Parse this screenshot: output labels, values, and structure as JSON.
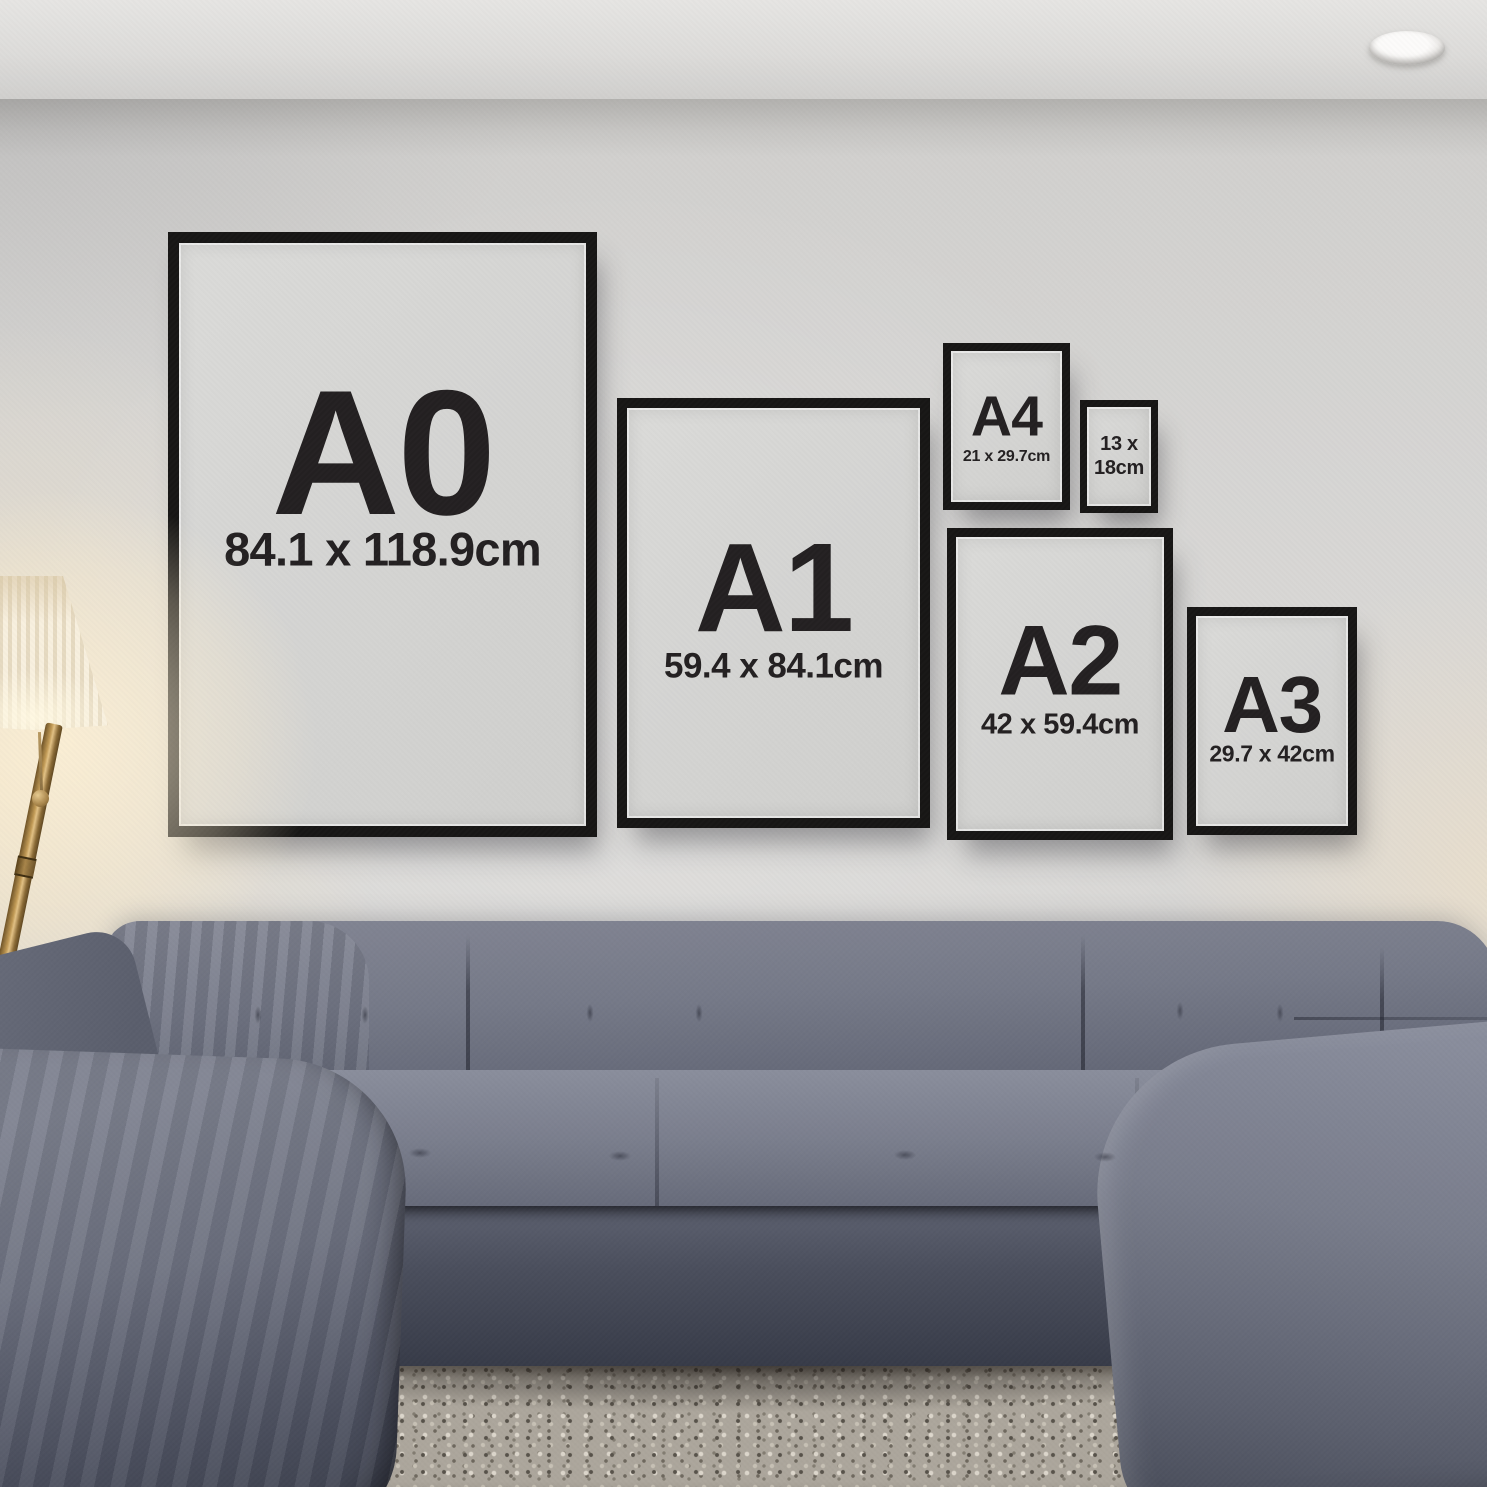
{
  "frames": [
    {
      "id": "a0",
      "label": "A0",
      "dims": "84.1 x 118.9cm"
    },
    {
      "id": "a1",
      "label": "A1",
      "dims": "59.4 x 84.1cm"
    },
    {
      "id": "a4",
      "label": "A4",
      "dims": "21 x 29.7cm"
    },
    {
      "id": "13x18",
      "label": "",
      "dims": "13 x\n18cm"
    },
    {
      "id": "a2",
      "label": "A2",
      "dims": "42 x 59.4cm"
    },
    {
      "id": "a3",
      "label": "A3",
      "dims": "29.7 x 42cm"
    }
  ],
  "colors": {
    "frame_black": "#171615",
    "poster_paper": "#d4d4d2",
    "poster_ink": "#232021",
    "wall": "#d6d5d3",
    "ceiling": "#e2e1df",
    "sofa": "#6f7382",
    "sofa_shadow": "#3f4350",
    "rug": "#aca69c",
    "floor": "#33241c",
    "lamp_glow": "#f7ecd2",
    "lamp_brass": "#a8854a"
  }
}
